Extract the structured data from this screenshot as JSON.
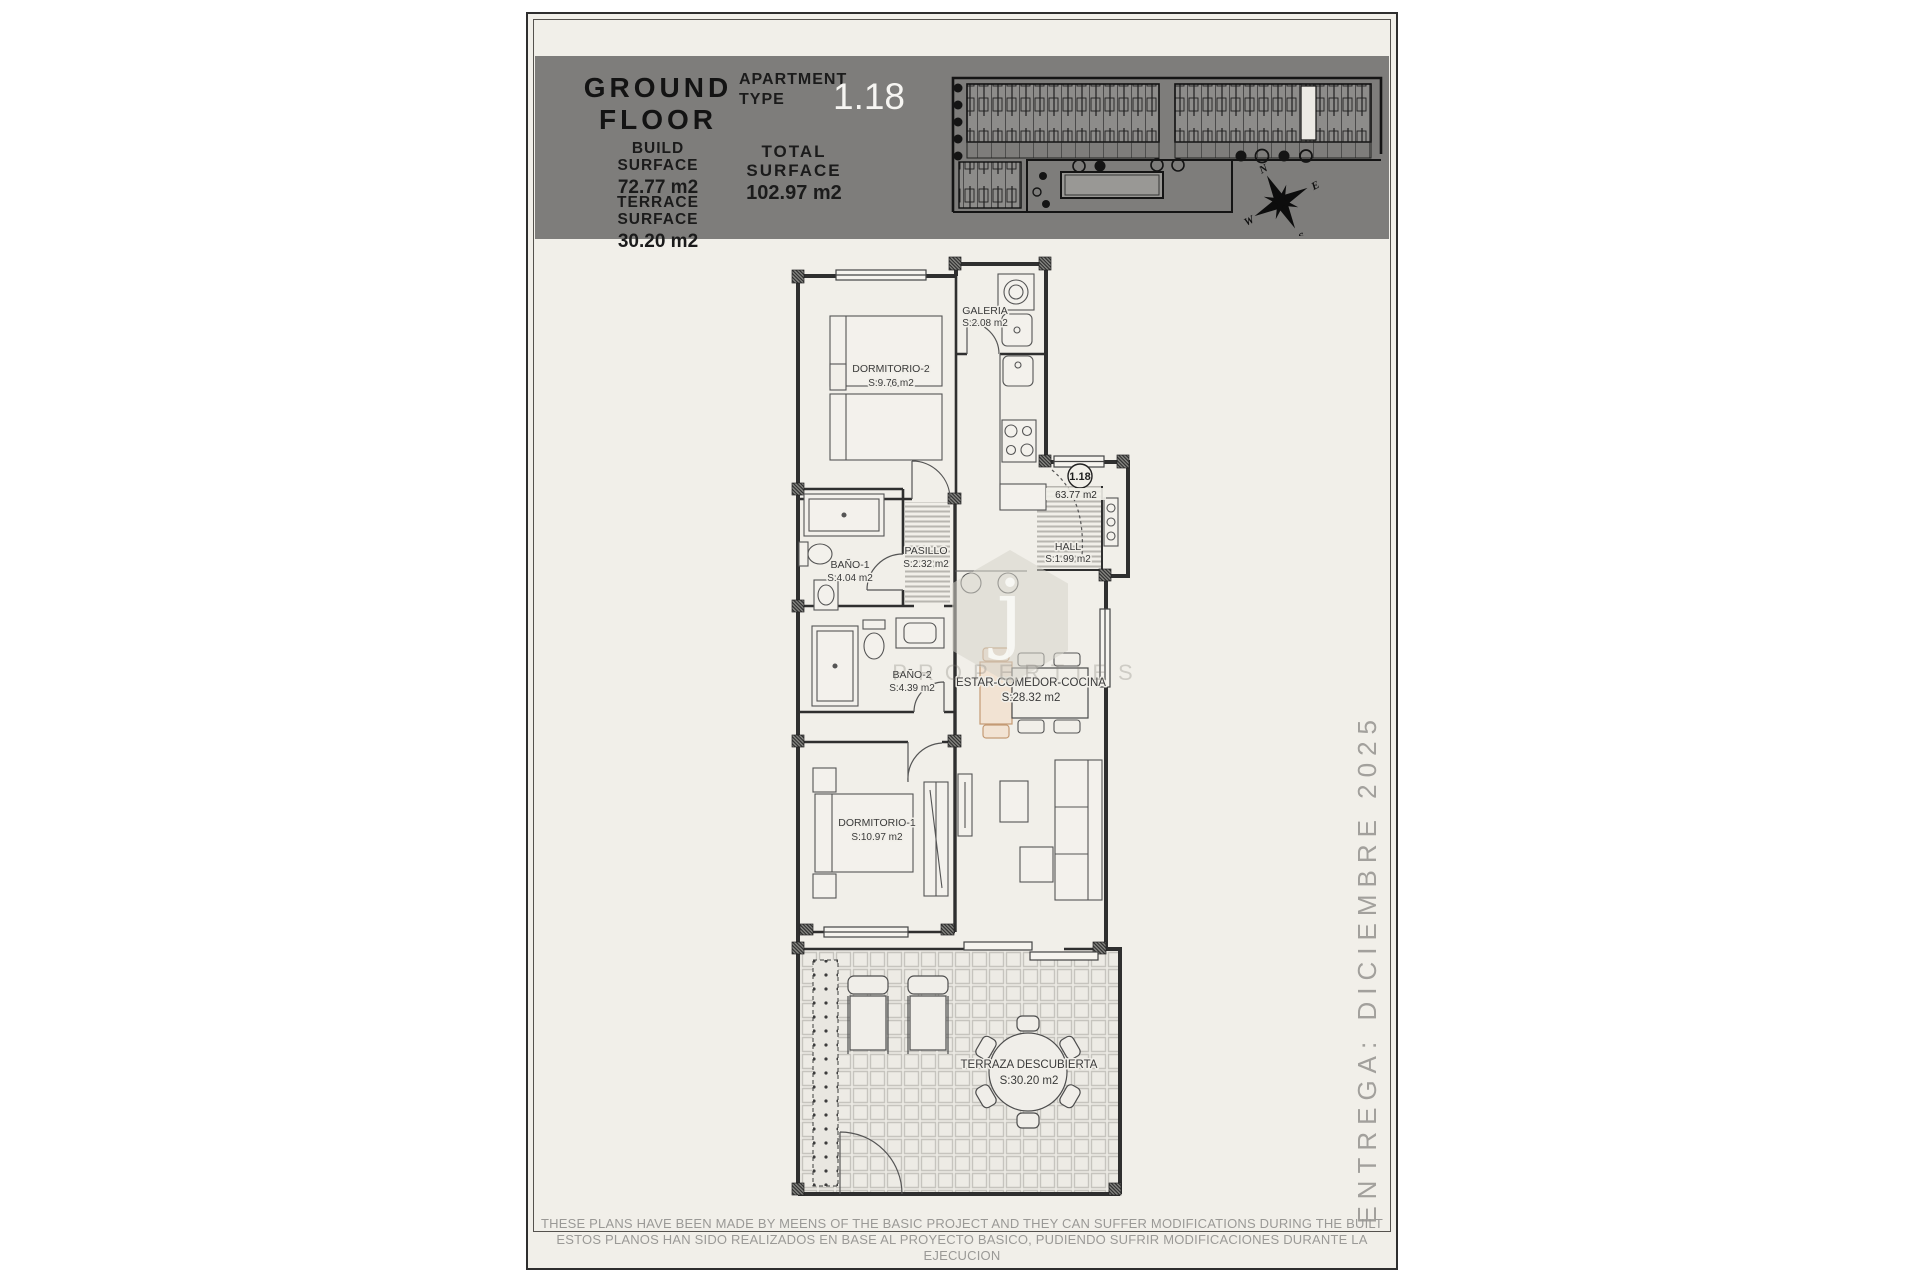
{
  "header": {
    "title_line1": "GROUND",
    "title_line2": "FLOOR",
    "build_surface_label": "BUILD SURFACE",
    "build_surface_value": "72.77 m2",
    "terrace_surface_label": "TERRACE SURFACE",
    "terrace_surface_value": "30.20 m2",
    "apartment_label": "APARTMENT TYPE",
    "apartment_value": "1.18",
    "total_label": "TOTAL SURFACE",
    "total_value": "102.97 m2"
  },
  "site_plan": {
    "compass": {
      "n": "N",
      "e": "E",
      "s": "S",
      "w": "W"
    }
  },
  "plan": {
    "unit_badge": "1.18",
    "unit_area_note": "63.77 m2",
    "rooms": {
      "dormitorio2": {
        "name": "DORMITORIO-2",
        "area": "S:9.76 m2"
      },
      "galeria": {
        "name": "GALERIA",
        "area": "S:2.08 m2"
      },
      "bano1": {
        "name": "BAÑO-1",
        "area": "S:4.04 m2"
      },
      "pasillo": {
        "name": "PASILLO",
        "area": "S:2.32 m2"
      },
      "hall": {
        "name": "HALL",
        "area": "S:1.99 m2"
      },
      "bano2": {
        "name": "BAÑO-2",
        "area": "S:4.39 m2"
      },
      "estar": {
        "name": "ESTAR-COMEDOR-COCINA",
        "area": "S:28.32 m2"
      },
      "dormitorio1": {
        "name": "DORMITORIO-1",
        "area": "S:10.97 m2"
      },
      "terraza": {
        "name": "TERRAZA DESCUBIERTA",
        "area": "S:30.20 m2"
      }
    }
  },
  "delivery_note": "ENTREGA: DICIEMBRE 2025",
  "watermark": {
    "letter": "j",
    "text": "PROPERTIES"
  },
  "footer": {
    "line_en": "THESE PLANS HAVE BEEN MADE BY MEENS OF THE BASIC PROJECT AND THEY CAN SUFFER MODIFICATIONS DURING THE BUILT",
    "line_es": "ESTOS PLANOS HAN SIDO REALIZADOS EN BASE AL PROYECTO BASICO, PUDIENDO SUFRIR MODIFICACIONES DURANTE LA EJECUCION"
  },
  "colors": {
    "header_bar": "#7e7d7b",
    "sheet_bg": "#f1efe9",
    "accent_tan": "#c49a74",
    "line": "#2f2f2f"
  }
}
